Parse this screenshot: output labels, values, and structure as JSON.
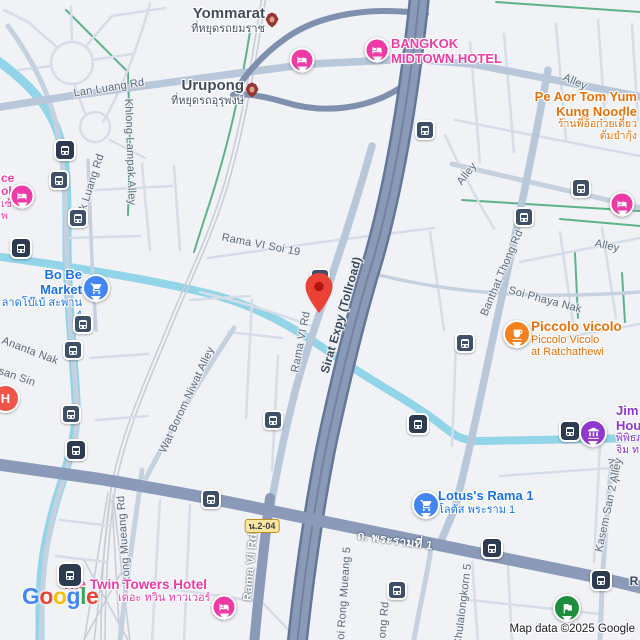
{
  "colors": {
    "land": "#f0f2f5",
    "water": "#92d4e8",
    "park": "#c9e7cb",
    "field": "#b3e1b5",
    "sand": "#f7f0e1",
    "pink_area": "#fbe7e3",
    "hospital_area": "#fae6ea",
    "minor": "#d6dde8",
    "medium": "#c6d1e0",
    "major_light": "#b9c7da",
    "major_dark": "#8a9ab8",
    "expressway": "#8b9ab6",
    "expressway_casing": "#63769c",
    "ramp": "#7e90ae",
    "rail": "#c9ced6",
    "khlong_green": "#5cb389",
    "road_label": "#5b6b7d",
    "transit_label": "#414d5b",
    "arrow": "#8b97a6",
    "hotel": "#ee3aa5",
    "shopping": "#4285f4",
    "shopping_text": "#1a73e8",
    "food": "#f4801f",
    "food_text": "#e8710a",
    "museum": "#8f37cf",
    "hospital": "#ee5448",
    "green_poi": "#1e8e3e",
    "transit_bus": "#3e5068",
    "transit_train": "#2c3b50",
    "shield_bg": "#fbe7a2",
    "shield_border": "#c09022",
    "pin_red": "#EA4335",
    "pin_red_inner": "#B31412"
  },
  "roads": {
    "lan_luang": "Lan Luang Rd",
    "luk_luang": "Luk Luang Rd",
    "khlong_lampak": "Khlong Lampak Alley",
    "rama6_soi19": "Rama VI Soi 19",
    "rama6_a": "Rama VI Rd",
    "rama6_b": "Rama VI Rd",
    "sirat": "Sirat Expy (Tollroad)",
    "banthat": "Banthat Thong Rd",
    "soi_phaya_nak": "Soi Phaya Nak",
    "alley_1": "Alley",
    "alley_2": "Alley",
    "alley_3": "Alley",
    "alley_4": "Alley",
    "wat_borom": "Wat Borom Niwat Alley",
    "ananta_nak": "Ananta Nak",
    "san_sin": "san Sin",
    "rong_mueang": "Rong Mueang Rd",
    "rama1_thai": "ถ. พระรามที่ 1",
    "soi_rong_mueang5": "Soi Rong Mueang 5",
    "ong_rd": "ong Rd",
    "chulalongkorn5": "Chulalongkorn 5",
    "kasem_san2": "Kasem San 2 Alley",
    "shield": "น.2-04",
    "r_partial": "R"
  },
  "pois": {
    "yommarat": {
      "name": "Yommarat",
      "thai": "ที่หยุดรถยมราช"
    },
    "urupong": {
      "name": "Urupong",
      "thai": "ที่หยุดรถอุรุพงษ์"
    },
    "bangkok_midtown": {
      "line1": "BANGKOK",
      "line2": "MIDTOWN HOTEL"
    },
    "pe_aor": {
      "line1": "Pe Aor Tom Yum",
      "line2": "Kung Noodle",
      "thai1": "ร้านพี่อ้อก๋วยเตี๋ยว",
      "thai2": "ต้มยำกุ้ง"
    },
    "bobe": {
      "name": "Bo Be Market",
      "thai": "ลาดโบ๊เบ้ สะพาน 4"
    },
    "piccolo": {
      "name": "Piccolo vicolo",
      "sub1": "Piccolo Vicolo",
      "sub2": "at Ratchathewi"
    },
    "jim": {
      "line1": "Jim T",
      "line2": "Hous",
      "thai1": "พิพิธภ",
      "thai2": "จิม ทอ"
    },
    "lotus": {
      "name": "Lotus's Rama 1",
      "thai": "โลตัส พระราม 1"
    },
    "twin": {
      "name": "The Twin Towers Hotel",
      "thai": "เดอะ ทวิน ทาวเวอร์"
    },
    "edge_hotel": {
      "line1": "ce",
      "line2": "ok",
      "line3": "เช้",
      "line4": "พ"
    },
    "hospital": {
      "label": "H"
    }
  },
  "logo": {
    "letters": [
      "G",
      "o",
      "o",
      "g",
      "l",
      "e"
    ],
    "styles": [
      "color:#4285F4",
      "color:#EA4335",
      "color:#FBBC05",
      "color:#4285F4",
      "color:#34A853",
      "color:#EA4335"
    ]
  },
  "attribution": "Map data ©2025 Google"
}
